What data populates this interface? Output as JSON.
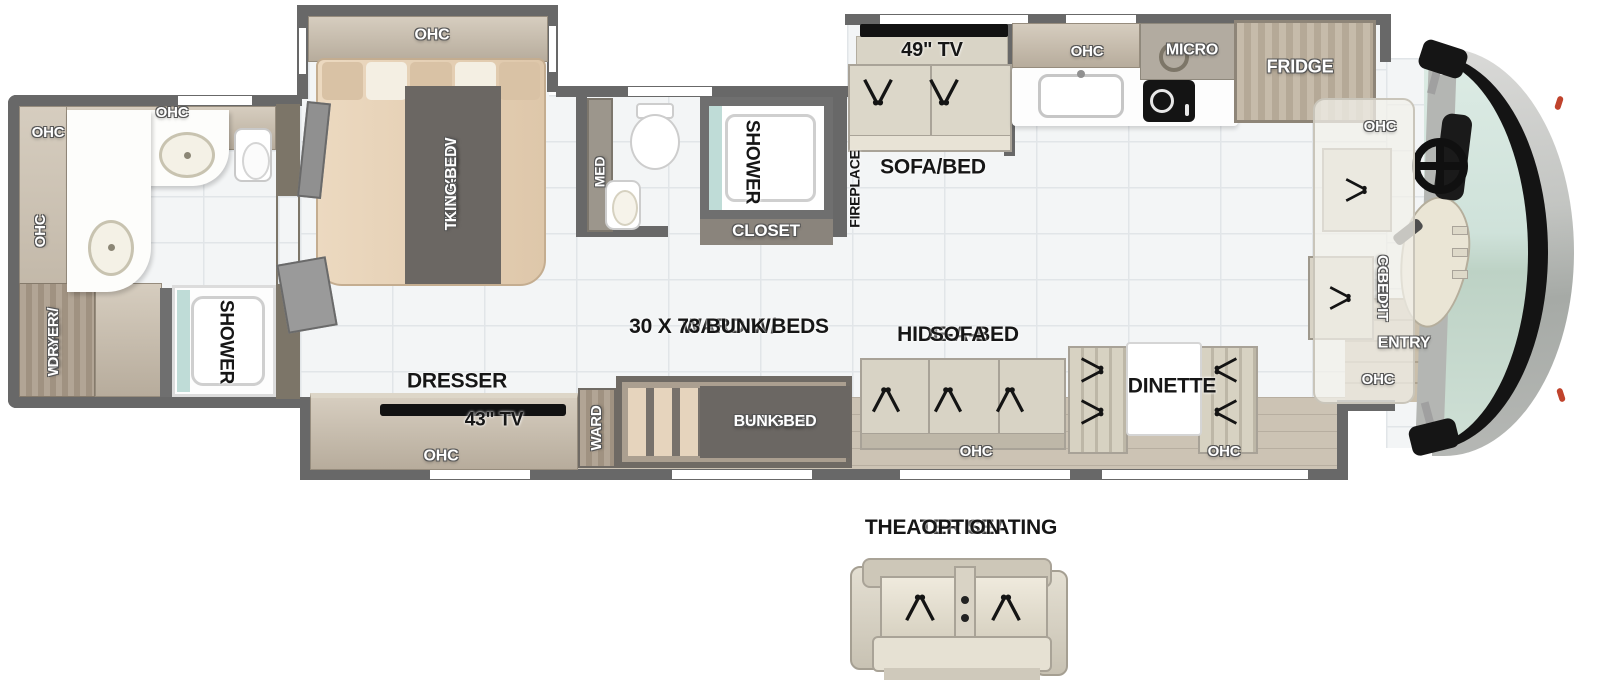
{
  "rear_bath": {
    "ohc_top_left": "OHC",
    "ohc_top": "OHC",
    "ohc_side": "OHC",
    "washer_dryer_line1": "WASHER/",
    "washer_dryer_line2": "DRYER",
    "shower": "SHOWER"
  },
  "bedroom": {
    "ohc": "OHC",
    "king_bed_line1": "72 X 80",
    "king_bed_line2": "TILT-A-VIEW",
    "king_bed_line3": "KING BED",
    "dresser": "DRESSER",
    "tv": "43\" TV",
    "ohc_bottom": "OHC",
    "ward": "WARD"
  },
  "mid_bath": {
    "med": "MED",
    "shower": "SHOWER",
    "closet": "CLOSET"
  },
  "living": {
    "fireplace": "FIREPLACE",
    "tv": "49\" TV",
    "sofa_bed": "SOFA/BED"
  },
  "kitchen": {
    "ohc": "OHC",
    "micro": "MICRO",
    "fridge": "FRIDGE"
  },
  "bunk_area": {
    "caption_line1": "WARD W/",
    "caption_line2": "30 X 73 BUNK BEDS",
    "hinged_line1": "HINGED",
    "hinged_line2": "BUNK BED"
  },
  "hide_a_bed": {
    "caption_line1": "HIDE-A-BED",
    "caption_line2": "SOFA",
    "ohc": "OHC"
  },
  "dinette": {
    "caption": "DINETTE",
    "ohc": "OHC"
  },
  "cockpit": {
    "ohc_top": "OHC",
    "bed_line1": "COCKPIT",
    "bed_line2": "BED",
    "entry": "ENTRY",
    "ohc_bottom": "OHC"
  },
  "theater": {
    "caption_line1": "THEATER SEATING",
    "caption_line2": "OPTION"
  },
  "colors": {
    "wall": "#686868",
    "cabinet_wood": "#c6bcae",
    "dark_wood": "#a89d8f",
    "furniture_beige": "#d8d3c6",
    "bed_tan": "#e6d0b6",
    "label_banner": "#6b6763",
    "windshield_teal": "#cfe2da",
    "tv_black": "#141414"
  }
}
